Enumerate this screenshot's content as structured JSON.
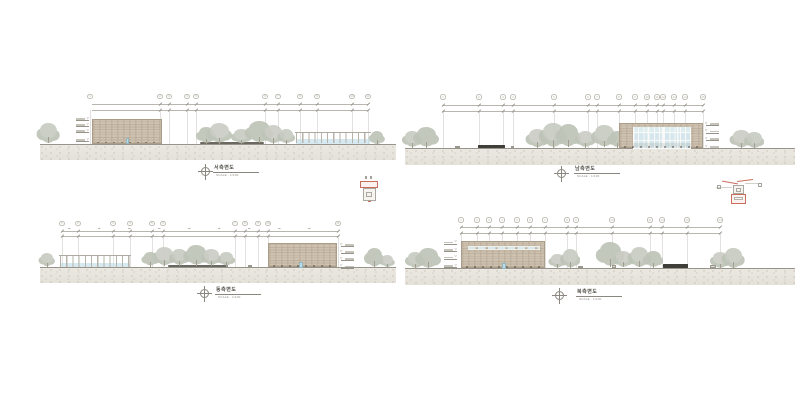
{
  "drawing": {
    "background": "#ffffff",
    "palette": {
      "line": "#8f8c84",
      "light_line": "#b8b5ad",
      "ground_fill": "#e9e6df",
      "ground_edge": "#97948b",
      "brick": "#cdc1b0",
      "brick_border": "#a99c88",
      "glass": "#d8e9ee",
      "mullion": "#fafaf8",
      "foliage": "#c7cbc2",
      "foliage_dark": "#bec4b8",
      "trunk": "#a49e91",
      "dark_element": "#403e38",
      "keyplan_red": "#c96e5d",
      "title_text": "#55524b",
      "scale_text": "#8f8c84"
    },
    "level_glyph": "▽",
    "panels": [
      {
        "id": "west",
        "title": "서측면도",
        "scale_label": "SCALE : 1/100",
        "title_block": {
          "cx": 205,
          "cy": 171,
          "tx": 214,
          "ty": 165.5
        },
        "bubbles": {
          "cy": 96.5,
          "xs": [
            90,
            160,
            169,
            187,
            196,
            265,
            278,
            300,
            317,
            352,
            368
          ],
          "labels": [
            "1",
            "2",
            "3",
            "4",
            "5",
            "6",
            "7",
            "8",
            "9",
            "10",
            "11"
          ]
        },
        "dims": [
          {
            "x1": 92,
            "x2": 368,
            "y": 104
          },
          {
            "x1": 92,
            "x2": 368,
            "y": 109.5
          }
        ],
        "ground": {
          "x": 40,
          "y": 143.5,
          "w": 356,
          "h": 16.5
        },
        "buildings": [
          {
            "type": "brick",
            "x": 92,
            "y": 119,
            "w": 70,
            "h": 24.5,
            "door": {
              "dx": 32.5,
              "w": 3.5,
              "h": 6
            }
          }
        ],
        "pergolas": [
          {
            "x": 296,
            "w": 74,
            "beam_y": 131.5
          }
        ],
        "hedges": [
          {
            "x": 200,
            "y": 141.5,
            "w": 64,
            "h": 2
          }
        ],
        "benches": [],
        "boxes": [],
        "trees": [
          [
            48,
            143.5,
            17,
            21
          ],
          [
            206,
            144,
            15,
            17
          ],
          [
            219,
            144,
            19,
            21
          ],
          [
            241,
            144,
            15,
            15
          ],
          [
            259,
            143.5,
            21,
            23
          ],
          [
            273,
            144,
            17,
            19
          ],
          [
            286,
            144,
            13,
            15
          ],
          [
            377,
            144.5,
            12,
            14
          ]
        ],
        "levels": {
          "x": 76,
          "side": "left",
          "ys": [
            118,
            124,
            130,
            139
          ]
        }
      },
      {
        "id": "south",
        "title": "남측면도",
        "scale_label": "SCALE : 1/100",
        "title_block": {
          "cx": 561,
          "cy": 173,
          "tx": 575,
          "ty": 167
        },
        "bubbles": {
          "cy": 97,
          "xs": [
            443,
            479,
            503,
            513,
            554,
            588,
            597,
            619,
            635,
            647,
            657,
            663,
            674,
            685,
            703
          ],
          "labels": [
            "1",
            "2",
            "3",
            "4",
            "5",
            "6",
            "7",
            "8",
            "9",
            "10",
            "11",
            "12",
            "13",
            "14",
            "15"
          ]
        },
        "dims": [
          {
            "x1": 443,
            "x2": 703,
            "y": 105
          },
          {
            "x1": 443,
            "x2": 703,
            "y": 110.5
          }
        ],
        "ground": {
          "x": 405,
          "y": 148,
          "w": 390,
          "h": 17
        },
        "buildings": [
          {
            "type": "glass",
            "x": 619,
            "y": 122.5,
            "w": 84,
            "h": 25.5,
            "pier_w": 13,
            "band_h": 3.5
          }
        ],
        "pergolas": [],
        "hedges": [],
        "benches": [
          {
            "x": 478,
            "y": 144.5,
            "w": 27,
            "h": 3.5
          }
        ],
        "boxes": [
          {
            "x": 455,
            "y": 145.5,
            "w": 5,
            "h": 2.5
          },
          {
            "x": 511,
            "y": 146,
            "w": 3,
            "h": 2
          }
        ],
        "trees": [
          [
            412,
            148,
            15,
            17
          ],
          [
            426,
            148,
            19,
            21
          ],
          [
            537,
            148,
            17,
            19
          ],
          [
            553,
            147.5,
            21,
            25
          ],
          [
            568,
            147,
            19,
            23
          ],
          [
            585,
            148,
            15,
            17
          ],
          [
            604,
            147.5,
            19,
            23
          ],
          [
            617,
            148,
            15,
            17
          ],
          [
            741,
            148.5,
            17,
            19
          ],
          [
            754,
            148.5,
            15,
            17
          ]
        ],
        "levels": {
          "x": 706,
          "side": "right",
          "ys": [
            123,
            130.5,
            138,
            146
          ]
        }
      },
      {
        "id": "east",
        "title": "동측면도",
        "scale_label": "SCALE : 1/100",
        "title_block": {
          "cx": 204,
          "cy": 293,
          "tx": 216,
          "ty": 287.5
        },
        "bubbles": {
          "cy": 223.5,
          "xs": [
            62,
            78,
            113,
            130,
            152,
            163,
            235,
            245,
            258,
            268,
            338
          ],
          "labels": [
            "1",
            "2",
            "3",
            "4",
            "5",
            "6",
            "7",
            "8",
            "9",
            "10",
            "11"
          ]
        },
        "dims": [
          {
            "x1": 62,
            "x2": 338,
            "y": 230.5
          },
          {
            "x1": 62,
            "x2": 338,
            "y": 236
          }
        ],
        "ground": {
          "x": 40,
          "y": 267,
          "w": 356,
          "h": 16
        },
        "buildings": [
          {
            "type": "brick",
            "x": 268,
            "y": 242.5,
            "w": 69,
            "h": 24.5,
            "door": {
              "dx": 30,
              "w": 3.5,
              "h": 5.5
            }
          }
        ],
        "pergolas": [
          {
            "x": 60,
            "w": 70,
            "beam_y": 255
          }
        ],
        "hedges": [
          {
            "x": 168,
            "y": 265,
            "w": 60,
            "h": 2
          }
        ],
        "benches": [],
        "boxes": [
          {
            "x": 248,
            "y": 264.5,
            "w": 4,
            "h": 2.5
          }
        ],
        "trees": [
          [
            47,
            267,
            12,
            14
          ],
          [
            150,
            266.5,
            13,
            15
          ],
          [
            164,
            266,
            17,
            19
          ],
          [
            179,
            266,
            15,
            17
          ],
          [
            196,
            266,
            19,
            21
          ],
          [
            211,
            266,
            15,
            17
          ],
          [
            226,
            266.5,
            13,
            15
          ],
          [
            374,
            267,
            15,
            19
          ],
          [
            387,
            267.5,
            11,
            13
          ]
        ],
        "levels": {
          "x": 341,
          "side": "right",
          "ys": [
            244,
            251,
            258,
            265.5
          ]
        }
      },
      {
        "id": "north",
        "title": "북측면도",
        "scale_label": "SCALE : 1/100",
        "title_block": {
          "cx": 559,
          "cy": 295,
          "tx": 577,
          "ty": 289.5
        },
        "bubbles": {
          "cy": 220,
          "xs": [
            461,
            477,
            489,
            502,
            517,
            530,
            545,
            567,
            576,
            612,
            650,
            662,
            687,
            720
          ],
          "labels": [
            "1",
            "2",
            "3",
            "4",
            "5",
            "6",
            "7",
            "8",
            "9",
            "10",
            "11",
            "12",
            "13",
            "14"
          ]
        },
        "dims": [
          {
            "x1": 461,
            "x2": 720,
            "y": 227
          },
          {
            "x1": 461,
            "x2": 720,
            "y": 233
          }
        ],
        "ground": {
          "x": 405,
          "y": 268,
          "w": 390,
          "h": 17
        },
        "buildings": [
          {
            "type": "brick-strip",
            "x": 461,
            "y": 240.5,
            "w": 84,
            "h": 27.5,
            "strip": {
              "dy": 4,
              "h": 4.5
            },
            "door": {
              "dx": 40,
              "w": 4,
              "h": 6
            }
          }
        ],
        "pergolas": [],
        "hedges": [],
        "benches": [
          {
            "x": 663,
            "y": 263.5,
            "w": 25,
            "h": 4.5
          }
        ],
        "boxes": [
          {
            "x": 578,
            "y": 265.5,
            "w": 5,
            "h": 2.5
          },
          {
            "x": 612,
            "y": 264.5,
            "w": 4,
            "h": 3
          },
          {
            "x": 710,
            "y": 264.5,
            "w": 6,
            "h": 3.5
          }
        ],
        "trees": [
          [
            415,
            269,
            15,
            17
          ],
          [
            428,
            268.5,
            19,
            21
          ],
          [
            557,
            268.5,
            13,
            15
          ],
          [
            570,
            268,
            15,
            19
          ],
          [
            610,
            266.5,
            21,
            25
          ],
          [
            623,
            267.5,
            15,
            17
          ],
          [
            639,
            267.5,
            17,
            21
          ],
          [
            653,
            268,
            15,
            17
          ],
          [
            720,
            269,
            15,
            17
          ],
          [
            733,
            268.5,
            17,
            21
          ]
        ],
        "levels": {
          "x": 444,
          "side": "left",
          "ys": [
            241.5,
            249,
            256.5,
            265
          ]
        }
      }
    ],
    "keyplans": [
      {
        "x": 355,
        "y": 176,
        "w": 30,
        "h": 27
      },
      {
        "x": 716,
        "y": 176,
        "w": 48,
        "h": 28
      }
    ]
  }
}
